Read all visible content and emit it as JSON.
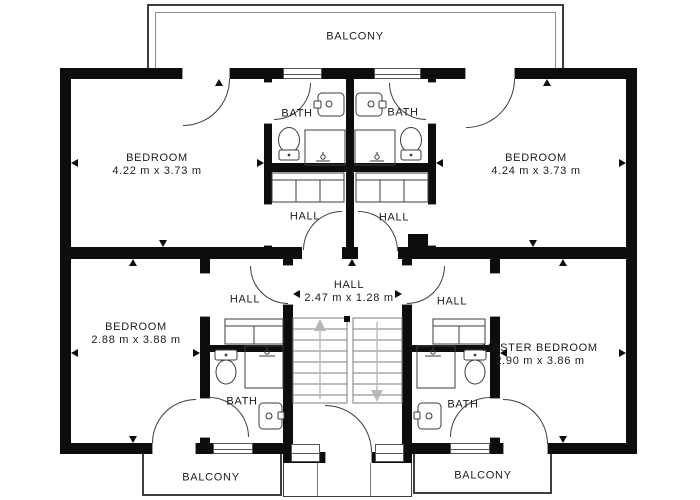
{
  "rooms": {
    "balcony_top": {
      "label": "BALCONY"
    },
    "bedroom_top_left": {
      "label": "BEDROOM",
      "dims": "4.22 m x 3.73 m"
    },
    "bedroom_top_right": {
      "label": "BEDROOM",
      "dims": "4.24 m x 3.73 m"
    },
    "bath_top_left": {
      "label": "BATH"
    },
    "bath_top_right": {
      "label": "BATH"
    },
    "hall_upper_left": {
      "label": "HALL"
    },
    "hall_upper_right": {
      "label": "HALL"
    },
    "hall_center": {
      "label": "HALL",
      "dims": "2.47 m x 1.28 m"
    },
    "hall_lower_left": {
      "label": "HALL"
    },
    "hall_lower_right": {
      "label": "HALL"
    },
    "bedroom_lower_left": {
      "label": "BEDROOM",
      "dims": "2.88 m x 3.88 m"
    },
    "master_bedroom": {
      "label": "MASTER BEDROOM",
      "dims": "2.90 m x 3.86 m"
    },
    "bath_lower_left": {
      "label": "BATH"
    },
    "bath_lower_right": {
      "label": "BATH"
    },
    "balcony_bottom_left": {
      "label": "BALCONY"
    },
    "balcony_bottom_right": {
      "label": "BALCONY"
    }
  },
  "colors": {
    "background": "#ffffff",
    "wall": "#0d0d0d",
    "line": "#3d3d3d",
    "text": "#1c1c1c",
    "stair_arrow": "#b8b8b8"
  }
}
